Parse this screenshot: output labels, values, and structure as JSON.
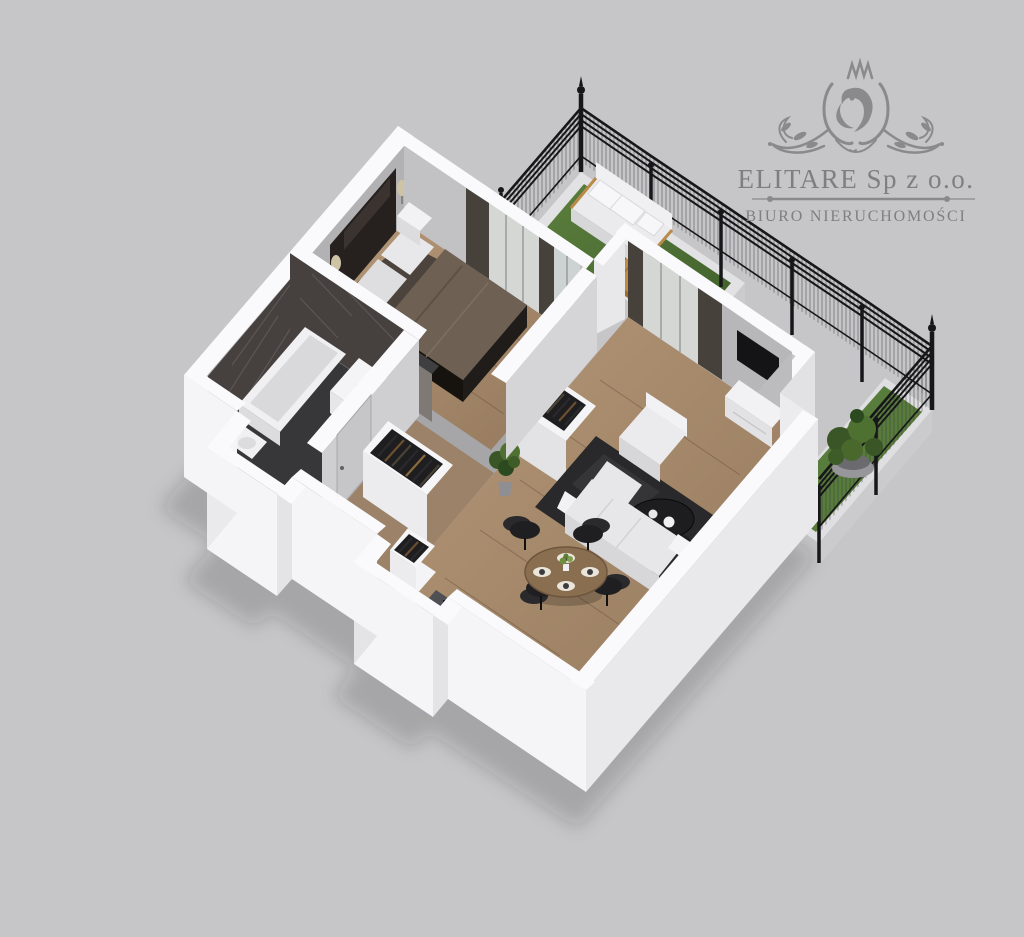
{
  "logo": {
    "company": "ELITARE Sp z o.o.",
    "tagline": "BIURO NIERUCHOMOŚCI",
    "emblem": "lion-crest-flourish-icon"
  },
  "palette": {
    "background": "#c6c6c8",
    "wall_top": "#fafafc",
    "wall_bright": "#f5f5f7",
    "wall_shade": "#e9e9eb",
    "wall_interior": "#bfbfc1",
    "slab_shade": "#cbcbcd",
    "floor_wood": "#a98e73",
    "floor_hall": "#9b8268",
    "floor_dark": "#37373a",
    "marble": "#46413f",
    "concrete": "#7e7975",
    "grass": "#587c3c",
    "grass_dark": "#41602a",
    "deck": "#c28a3e",
    "deck_dark": "#a06c2a",
    "fence": "#17171a",
    "white_furniture": "#ebebed",
    "white_furniture_shade": "#d7d7d9",
    "dark_furniture": "#1d1d1f",
    "blanket": "#6e6154",
    "table_wood": "#8a6e50",
    "rug": "#29292b",
    "plant": "#3a5626",
    "plant_light": "#4e7030",
    "curtain": "#46413b",
    "sheer": "#d5d7d5",
    "glass": "#ccd3d2",
    "logo": "#8a8a8c",
    "logo_text": "#7f7f82"
  },
  "scene": {
    "type": "isometric-3d-floor-plan",
    "rooms": [
      {
        "name": "bedroom",
        "furniture": [
          "double-bed",
          "headboard",
          "pillows",
          "nightstand",
          "wall-lamp",
          "curtains",
          "window"
        ]
      },
      {
        "name": "bathroom",
        "furniture": [
          "bathtub",
          "vanity-sink",
          "toilet",
          "marble-wall",
          "door"
        ]
      },
      {
        "name": "hallway",
        "furniture": [
          "open-wardrobe",
          "open-wardrobe-small",
          "entry-door"
        ]
      },
      {
        "name": "living-room",
        "furniture": [
          "sofa",
          "armchair",
          "coffee-table",
          "rug",
          "tv",
          "media-console",
          "wardrobe",
          "potted-plant"
        ]
      },
      {
        "name": "dining-area",
        "furniture": [
          "round-dining-table",
          "dining-chairs",
          "placemats",
          "centerpiece"
        ]
      },
      {
        "name": "kitchen",
        "furniture": [
          "counter",
          "cooktop",
          "tall-cabinet"
        ]
      },
      {
        "name": "terrace",
        "furniture": [
          "outdoor-sofa",
          "wooden-deck-table",
          "grass-lawn",
          "metal-fence",
          "planter-bowl"
        ]
      }
    ]
  }
}
